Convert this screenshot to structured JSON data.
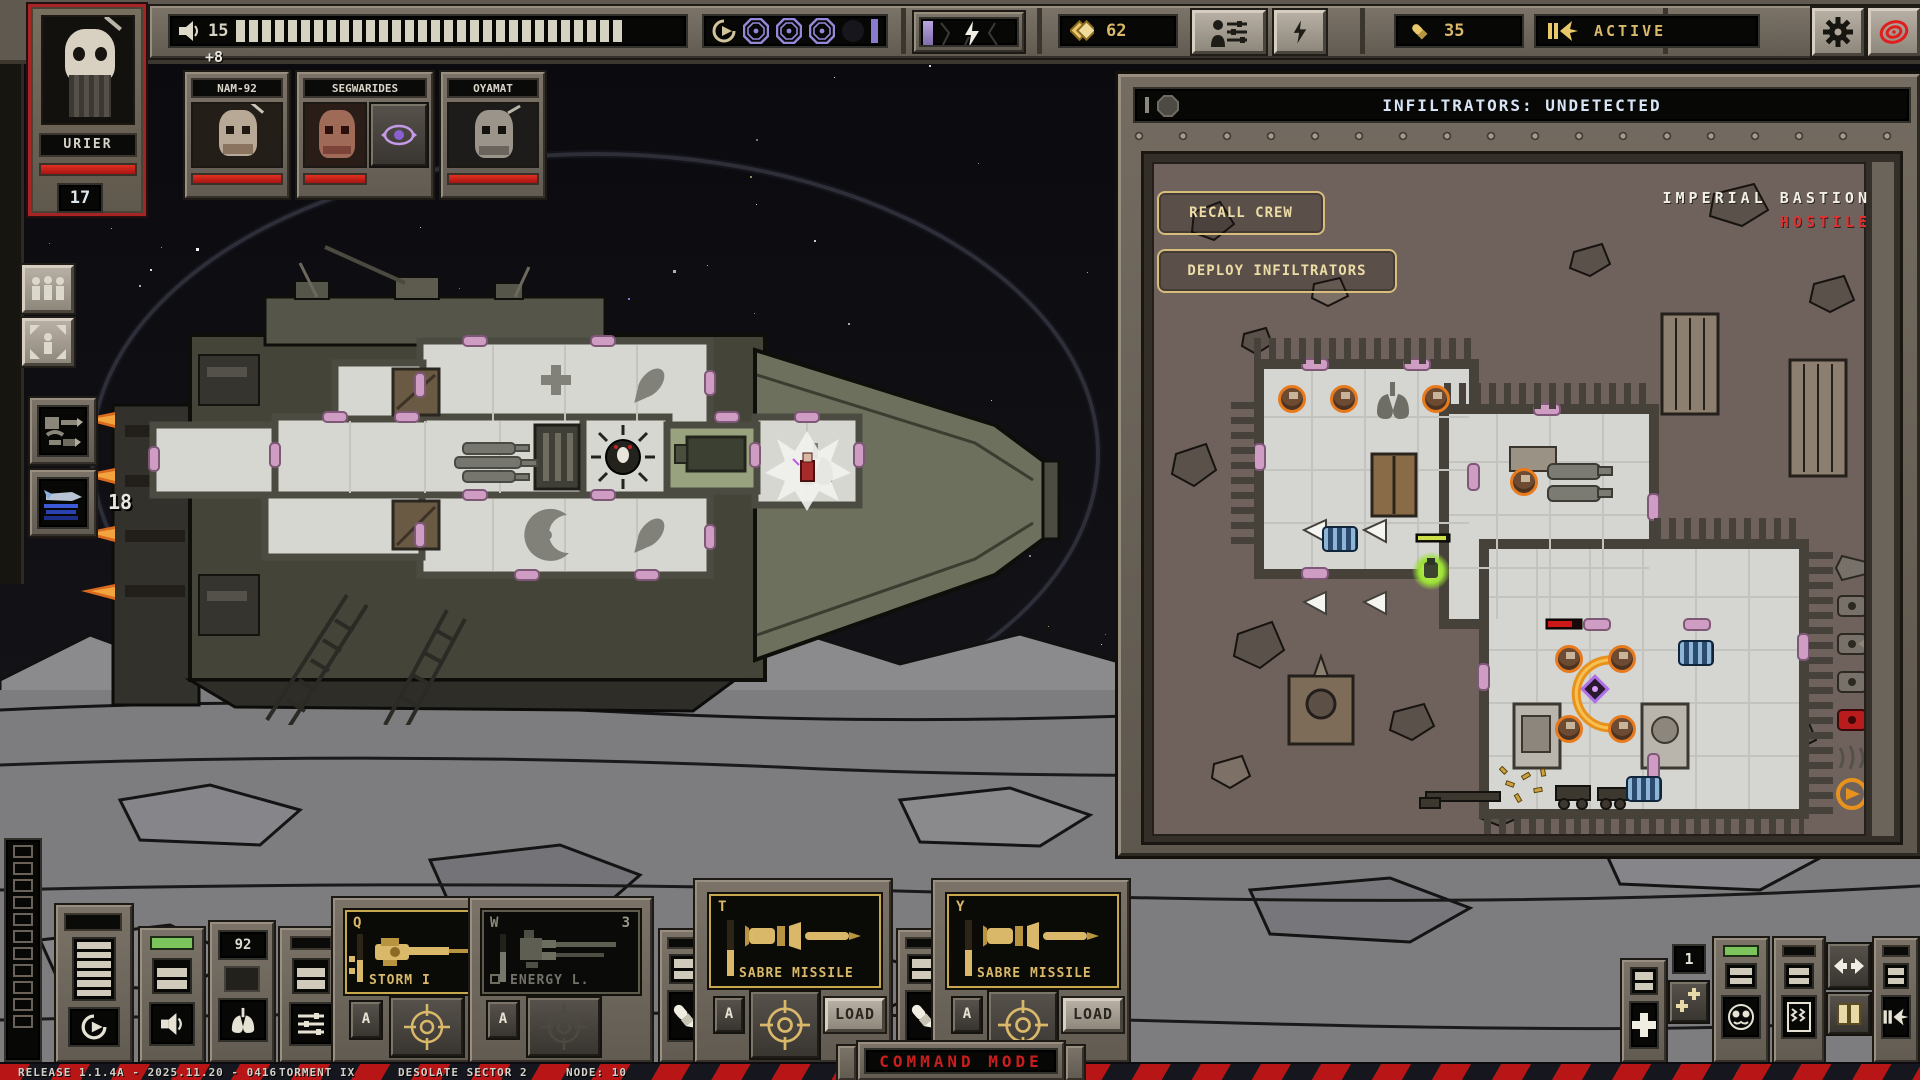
{
  "colors": {
    "accent_gold": "#d9b86a",
    "hostile_red": "#e03030",
    "health_red": "#c81e1e",
    "psy_purple": "#9b85d8",
    "header_blue": "#d4e2f4",
    "infiltrator_green": "#a6e43c",
    "enemy_orange": "#e87a1e"
  },
  "top_bar": {
    "morale": {
      "icon": "speaker-icon",
      "value": "15",
      "segments_total": 30,
      "segments_filled": 30
    },
    "warp": {
      "icon": "recall-arrow-icon",
      "charges_filled": 3,
      "charges_empty": 1
    },
    "battery": {
      "icon": "lightning-bolt-icon"
    },
    "scrap": {
      "icon": "diamond-icon",
      "value": "62"
    },
    "crew_button": {
      "icon": "crew-loadout-icon"
    },
    "power_button": {
      "icon": "lightning-bolt-icon"
    },
    "ammo": {
      "icon": "shell-icon",
      "value": "35"
    },
    "engine": {
      "icon": "engine-thruster-icon",
      "label": "ACTIVE"
    },
    "settings_button": {
      "icon": "gear-icon"
    },
    "alert_button": {
      "icon": "red-spiral-icon"
    }
  },
  "commander": {
    "name": "URIER",
    "value": "17"
  },
  "crew_bonus": "+8",
  "crew": [
    {
      "name": "NAM-92"
    },
    {
      "name": "SEGWARIDES",
      "badge": "psy-eye-icon"
    },
    {
      "name": "OYAMAT"
    }
  ],
  "ship": {
    "engine_power": "18"
  },
  "infiltration_panel": {
    "header": "INFILTRATORS: UNDETECTED",
    "recall_button": "RECALL CREW",
    "deploy_button": "DEPLOY INFILTRATORS",
    "location_name": "IMPERIAL BASTION",
    "location_status": "HOSTILE"
  },
  "weapon_slots": [
    {
      "hotkey": "Q",
      "name": "STORM I",
      "auto_label": "A",
      "count": ""
    },
    {
      "hotkey": "W",
      "name": "ENERGY L.",
      "auto_label": "A",
      "count": "3"
    },
    {
      "hotkey": "T",
      "name": "SABRE MISSILE",
      "auto_label": "A",
      "load_label": "LOAD"
    },
    {
      "hotkey": "Y",
      "name": "SABRE MISSILE",
      "auto_label": "A",
      "load_label": "LOAD"
    }
  ],
  "consoles": {
    "oxygen_value": "92",
    "squad_count": "1"
  },
  "status_bar": {
    "release": "RELEASE 1.1.4A - 2025.11.20 - 0416",
    "difficulty": "TORMENT IX",
    "sector": "DESOLATE SECTOR 2",
    "node": "NODE: 10",
    "mode": "COMMAND MODE"
  }
}
